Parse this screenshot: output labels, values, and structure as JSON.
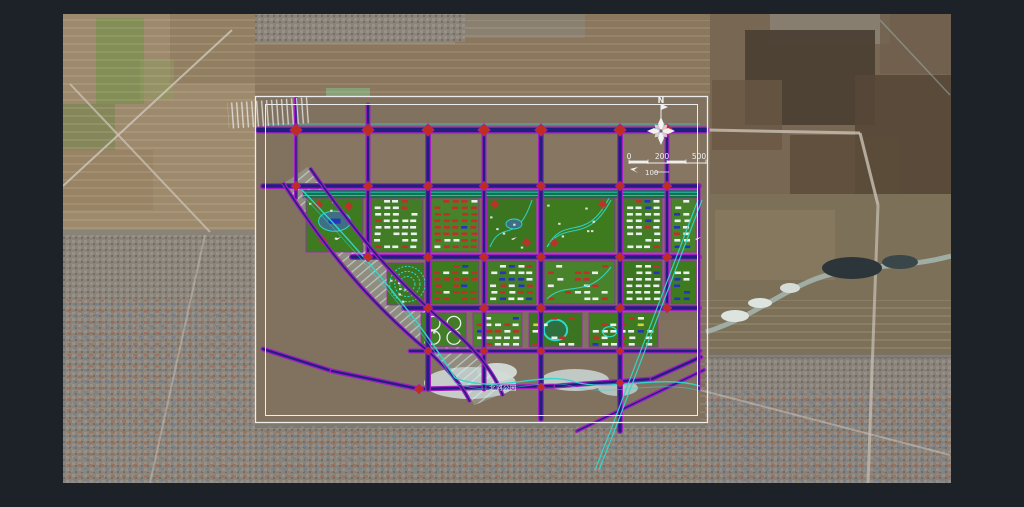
{
  "palette": {
    "page_bg": "#1c2228",
    "road_edge": "#a21fc4",
    "road_fill": "#20207c",
    "diamond": "#bf2c20",
    "frame": "#ececec",
    "cyan": "#2fd8cc",
    "belt": "#11714d",
    "white": "#ecefef",
    "red": "#c03028",
    "blue": "#2433c0",
    "yellow": "#d8d23a",
    "block_greens": [
      "#3c7c1e",
      "#417d26",
      "#47842a",
      "#3a761f"
    ]
  },
  "satellite": {
    "x": 63,
    "y": 14,
    "w": 888,
    "h": 469,
    "base": "#80725f",
    "patches": [
      {
        "r": [
          63,
          14,
          192,
          216
        ],
        "c": "#9d8a6d",
        "o": 1
      },
      {
        "r": [
          170,
          14,
          85,
          70
        ],
        "c": "#8d7a5e",
        "o": 0.7
      },
      {
        "r": [
          96,
          18,
          48,
          86
        ],
        "c": "#7f8d52",
        "o": 0.85
      },
      {
        "r": [
          63,
          104,
          52,
          46
        ],
        "c": "#75854e",
        "o": 0.6
      },
      {
        "r": [
          140,
          60,
          34,
          40
        ],
        "c": "#8d9a5e",
        "o": 0.5
      },
      {
        "r": [
          63,
          150,
          90,
          60
        ],
        "c": "#957f60",
        "o": 0.6
      },
      {
        "r": [
          63,
          230,
          192,
          253
        ],
        "c": "#8a8378",
        "o": 1
      },
      {
        "r": [
          255,
          14,
          455,
          82
        ],
        "c": "#8a775d",
        "o": 1
      },
      {
        "r": [
          255,
          14,
          200,
          30
        ],
        "c": "#8f897e",
        "o": 0.8
      },
      {
        "r": [
          455,
          14,
          130,
          24
        ],
        "c": "#8a8478",
        "o": 0.7
      },
      {
        "r": [
          326,
          88,
          44,
          34
        ],
        "c": "#87a478",
        "o": 0.9
      },
      {
        "r": [
          344,
          150,
          30,
          20
        ],
        "c": "#93ad80",
        "o": 0.8
      },
      {
        "r": [
          342,
          212,
          44,
          32
        ],
        "c": "#8aa882",
        "o": 0.9
      },
      {
        "r": [
          710,
          14,
          241,
          180
        ],
        "c": "#786753",
        "o": 1
      },
      {
        "r": [
          770,
          14,
          120,
          30
        ],
        "c": "#8b8274",
        "o": 0.85
      },
      {
        "r": [
          745,
          30,
          130,
          95
        ],
        "c": "#4c4034",
        "o": 0.95
      },
      {
        "r": [
          855,
          75,
          96,
          120
        ],
        "c": "#564737",
        "o": 0.9
      },
      {
        "r": [
          790,
          135,
          110,
          85
        ],
        "c": "#5c4c3a",
        "o": 0.85
      },
      {
        "r": [
          712,
          80,
          70,
          70
        ],
        "c": "#6a5845",
        "o": 0.8
      },
      {
        "r": [
          880,
          14,
          71,
          60
        ],
        "c": "#6f5f4c",
        "o": 0.8
      },
      {
        "r": [
          710,
          194,
          241,
          160
        ],
        "c": "#7d7058",
        "o": 1
      },
      {
        "r": [
          715,
          210,
          120,
          70
        ],
        "c": "#8a7c62",
        "o": 0.7
      },
      {
        "r": [
          705,
          354,
          246,
          129
        ],
        "c": "#77736c",
        "o": 1
      },
      {
        "r": [
          255,
          423,
          450,
          60
        ],
        "c": "#7e786d",
        "o": 1
      },
      {
        "r": [
          255,
          96,
          455,
          327
        ],
        "c": "#80725f",
        "o": 1
      },
      {
        "r": [
          300,
          135,
          400,
          50
        ],
        "c": "#8a7a64",
        "o": 0.6
      },
      {
        "r": [
          430,
          200,
          270,
          120
        ],
        "c": "#776a57",
        "o": 0.5
      }
    ],
    "row_zones": [
      [
        63,
        14,
        192,
        216
      ],
      [
        255,
        20,
        455,
        76
      ],
      [
        700,
        300,
        251,
        120
      ]
    ],
    "urban_zones": [
      [
        63,
        235,
        192,
        248
      ],
      [
        255,
        428,
        450,
        55
      ],
      [
        705,
        358,
        246,
        125
      ],
      [
        255,
        14,
        210,
        28
      ]
    ],
    "town_zones": [
      [
        63,
        300,
        192,
        183
      ],
      [
        260,
        425,
        440,
        55
      ],
      [
        705,
        390,
        246,
        93
      ]
    ],
    "roads": [
      {
        "l": [
          63,
          186,
          232,
          30
        ],
        "c": "#cfc8ba",
        "w": 2,
        "o": 0.8
      },
      {
        "l": [
          70,
          84,
          210,
          232
        ],
        "c": "#cfc8ba",
        "w": 2,
        "o": 0.7
      },
      {
        "l": [
          205,
          235,
          150,
          483
        ],
        "c": "#c5beb2",
        "w": 2,
        "o": 0.5
      },
      {
        "l": [
          708,
          130,
          860,
          133
        ],
        "c": "#c9c2b6",
        "w": 3,
        "o": 0.8
      },
      {
        "l": [
          860,
          133,
          878,
          205
        ],
        "c": "#c9c2b6",
        "w": 3,
        "o": 0.8
      },
      {
        "l": [
          878,
          205,
          868,
          483
        ],
        "c": "#c9c2b6",
        "w": 3,
        "o": 0.7
      },
      {
        "l": [
          700,
          390,
          950,
          455
        ],
        "c": "#c9c2b6",
        "w": 2,
        "o": 0.55
      },
      {
        "l": [
          880,
          20,
          950,
          95
        ],
        "c": "#9db4ae",
        "w": 1.5,
        "o": 0.5
      }
    ],
    "river_path": "M706,332 C750,318 768,300 808,282 C850,263 900,270 951,256",
    "river_color": "#a3b4ae",
    "ice": [
      {
        "e": [
          735,
          316,
          14,
          6
        ],
        "c": "#dde3df"
      },
      {
        "e": [
          760,
          303,
          12,
          5
        ],
        "c": "#dde3df"
      },
      {
        "e": [
          790,
          288,
          10,
          5
        ],
        "c": "#d5dcd8"
      },
      {
        "e": [
          852,
          268,
          30,
          11
        ],
        "c": "#2c363a"
      },
      {
        "e": [
          900,
          262,
          18,
          7
        ],
        "c": "#39464a"
      }
    ],
    "ponds": [
      {
        "e": [
          470,
          383,
          46,
          16
        ],
        "c": "#c9d2cf"
      },
      {
        "e": [
          497,
          372,
          20,
          9
        ],
        "c": "#d4dbd8"
      },
      {
        "e": [
          575,
          380,
          34,
          11
        ],
        "c": "#c3cdc9"
      },
      {
        "e": [
          618,
          388,
          20,
          8
        ],
        "c": "#b9c4c1"
      }
    ]
  },
  "plan": {
    "frame_outer": [
      255.5,
      96.5,
      452,
      326
    ],
    "frame_inner": [
      265.5,
      104.5,
      432,
      311
    ],
    "corridor_band": "M296,175 C338,236 376,285 432,334 C460,357 478,378 487,400",
    "corridor_edges": [
      "M310,168 C352,228 392,278 448,326 C476,350 494,372 503,396",
      "M283,183 C322,243 360,292 416,341 C444,364 462,384 470,402"
    ],
    "rail": {
      "r": [
        228,
        100,
        82,
        26
      ],
      "rot": -4
    },
    "canal": "M700,200 L612,432 L597,470",
    "river_cyan": [
      "M302,190 C360,250 420,320 455,378",
      "M455,378 C500,395 540,370 575,382 C610,392 660,374 700,386"
    ],
    "north_canal": [
      265,
      124,
      700,
      124
    ],
    "belts": [
      [
        303,
        190,
        396,
        8
      ]
    ],
    "roads": [
      [
        258,
        130,
        706,
        130,
        7
      ],
      [
        263,
        186,
        699,
        186,
        6
      ],
      [
        352,
        257,
        699,
        257,
        6
      ],
      [
        404,
        308,
        699,
        308,
        6
      ],
      [
        410,
        351,
        700,
        351,
        5
      ],
      [
        263,
        349,
        332,
        371,
        5
      ],
      [
        332,
        371,
        419,
        389,
        5
      ],
      [
        419,
        389,
        556,
        386,
        5
      ],
      [
        556,
        386,
        652,
        379,
        5
      ],
      [
        652,
        379,
        701,
        357,
        5
      ],
      [
        577,
        431,
        704,
        370,
        4
      ],
      [
        296,
        98,
        296,
        198,
        4
      ],
      [
        368,
        105,
        368,
        257,
        5
      ],
      [
        428,
        130,
        428,
        389,
        6
      ],
      [
        484,
        130,
        484,
        389,
        5
      ],
      [
        541,
        130,
        541,
        419,
        6
      ],
      [
        620,
        130,
        620,
        431,
        6
      ],
      [
        667,
        130,
        667,
        308,
        5
      ],
      [
        699,
        186,
        699,
        390,
        3
      ]
    ],
    "diamonds": [
      [
        296,
        130,
        9
      ],
      [
        368,
        130,
        9
      ],
      [
        428,
        130,
        9
      ],
      [
        484,
        130,
        9
      ],
      [
        541,
        130,
        9
      ],
      [
        620,
        130,
        9
      ],
      [
        667,
        130,
        9
      ],
      [
        296,
        186,
        7
      ],
      [
        368,
        186,
        7
      ],
      [
        428,
        186,
        7
      ],
      [
        484,
        186,
        7
      ],
      [
        541,
        186,
        7
      ],
      [
        620,
        186,
        7
      ],
      [
        667,
        186,
        7
      ],
      [
        368,
        257,
        7
      ],
      [
        428,
        257,
        7
      ],
      [
        484,
        257,
        7
      ],
      [
        541,
        257,
        7
      ],
      [
        620,
        257,
        7
      ],
      [
        667,
        257,
        7
      ],
      [
        428,
        308,
        7
      ],
      [
        484,
        308,
        7
      ],
      [
        541,
        308,
        7
      ],
      [
        620,
        308,
        7
      ],
      [
        667,
        308,
        7
      ],
      [
        428,
        351,
        6
      ],
      [
        484,
        351,
        6
      ],
      [
        541,
        351,
        6
      ],
      [
        620,
        351,
        6
      ],
      [
        419,
        389,
        7
      ],
      [
        541,
        387,
        6
      ],
      [
        620,
        383,
        6
      ]
    ],
    "blocks": [
      {
        "r": [
          306,
          196,
          57,
          56
        ],
        "s": "park"
      },
      {
        "r": [
          371,
          196,
          52,
          56
        ],
        "s": "whiterows"
      },
      {
        "r": [
          431,
          196,
          48,
          56
        ],
        "s": "redrows"
      },
      {
        "r": [
          487,
          196,
          49,
          56
        ],
        "s": "parkpond"
      },
      {
        "r": [
          544,
          196,
          71,
          56
        ],
        "s": "parkgolf"
      },
      {
        "r": [
          623,
          196,
          39,
          56
        ],
        "s": "whiterows"
      },
      {
        "r": [
          671,
          196,
          25,
          56
        ],
        "s": "whiterows"
      },
      {
        "r": [
          387,
          263,
          37,
          42
        ],
        "s": "greenrings"
      },
      {
        "r": [
          431,
          261,
          48,
          43
        ],
        "s": "redrows"
      },
      {
        "r": [
          487,
          261,
          49,
          43
        ],
        "s": "mixed"
      },
      {
        "r": [
          544,
          261,
          71,
          43
        ],
        "s": "greenmix"
      },
      {
        "r": [
          623,
          261,
          39,
          43
        ],
        "s": "whiterows"
      },
      {
        "r": [
          671,
          261,
          25,
          43
        ],
        "s": "mixed"
      },
      {
        "r": [
          421,
          313,
          45,
          34
        ],
        "s": "tanks"
      },
      {
        "r": [
          473,
          313,
          49,
          34
        ],
        "s": "mixed"
      },
      {
        "r": [
          529,
          313,
          53,
          34
        ],
        "s": "stadium"
      },
      {
        "r": [
          589,
          313,
          69,
          34
        ],
        "s": "mixedy"
      }
    ],
    "markers": [
      [
        335,
        239
      ],
      [
        511,
        239
      ],
      [
        695,
        239
      ]
    ]
  },
  "compass": {
    "label": "N",
    "cx": 661,
    "cy": 131
  },
  "scalebar": {
    "labels": [
      "0",
      "200",
      "500"
    ],
    "sub": "100",
    "x0": 629,
    "x1": 706,
    "y": 163
  },
  "labels": {
    "river": "北河公园"
  }
}
